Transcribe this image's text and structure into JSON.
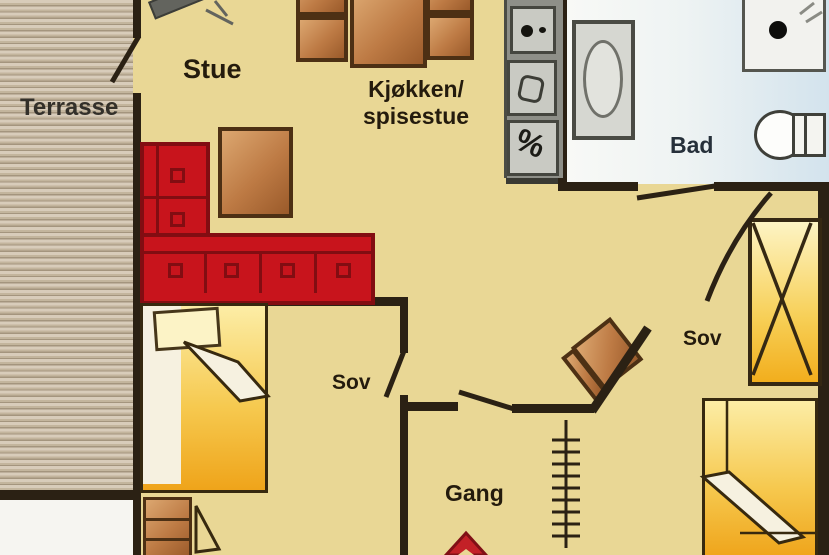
{
  "rooms": {
    "terrasse": {
      "label": "Terrasse"
    },
    "stue": {
      "label": "Stue"
    },
    "kjokken": {
      "line1": "Kjøkken/",
      "line2": "spisestue"
    },
    "bad": {
      "label": "Bad"
    },
    "sov_left": {
      "label": "Sov"
    },
    "sov_right": {
      "label": "Sov"
    },
    "gang": {
      "label": "Gang"
    }
  },
  "kitchen": {
    "dishwasher_symbol": "%"
  },
  "colors": {
    "floor": "#e9d795",
    "walls": "#2b2114",
    "terrace_stripe_light": "#d8ccba",
    "terrace_stripe_dark": "#a4957e",
    "sofa_red": "#c8141c",
    "sofa_dark_red": "#820d12",
    "wood_brown": "#bd7a44",
    "bed_yellow": "#f6c94f",
    "bath_floor_blue": "#d3e3ed",
    "counter_gray": "#8e8f88",
    "appliance_gray": "#c9cac3",
    "entrance_arrow_red": "#c32127"
  },
  "icons": [
    "wood-stove",
    "sofa",
    "coffee-table",
    "dining-table",
    "dining-chair",
    "cooktop",
    "kitchen-sink",
    "dishwasher",
    "bathtub",
    "washbasin",
    "toilet",
    "wardrobe",
    "bed",
    "desk",
    "desk-chair",
    "loft-ladder",
    "entrance-arrow",
    "door-leaf"
  ]
}
